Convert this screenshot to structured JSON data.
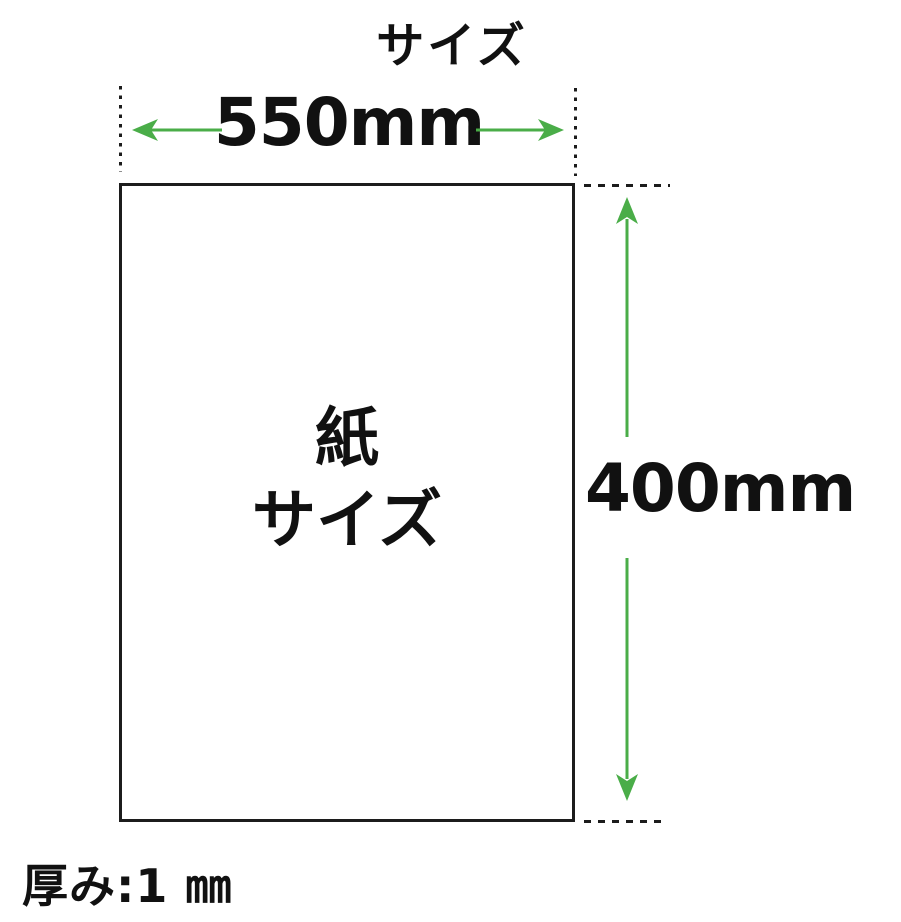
{
  "diagram": {
    "title": "サイズ",
    "width_label": "550mm",
    "height_label": "400mm",
    "paper_label": {
      "line1": "紙",
      "line2": "サイズ"
    },
    "thickness_label": "厚み:1 ㎜"
  },
  "colors": {
    "arrow_green": "#4aad48",
    "line_black": "#1c1c1c",
    "background": "#ffffff"
  }
}
